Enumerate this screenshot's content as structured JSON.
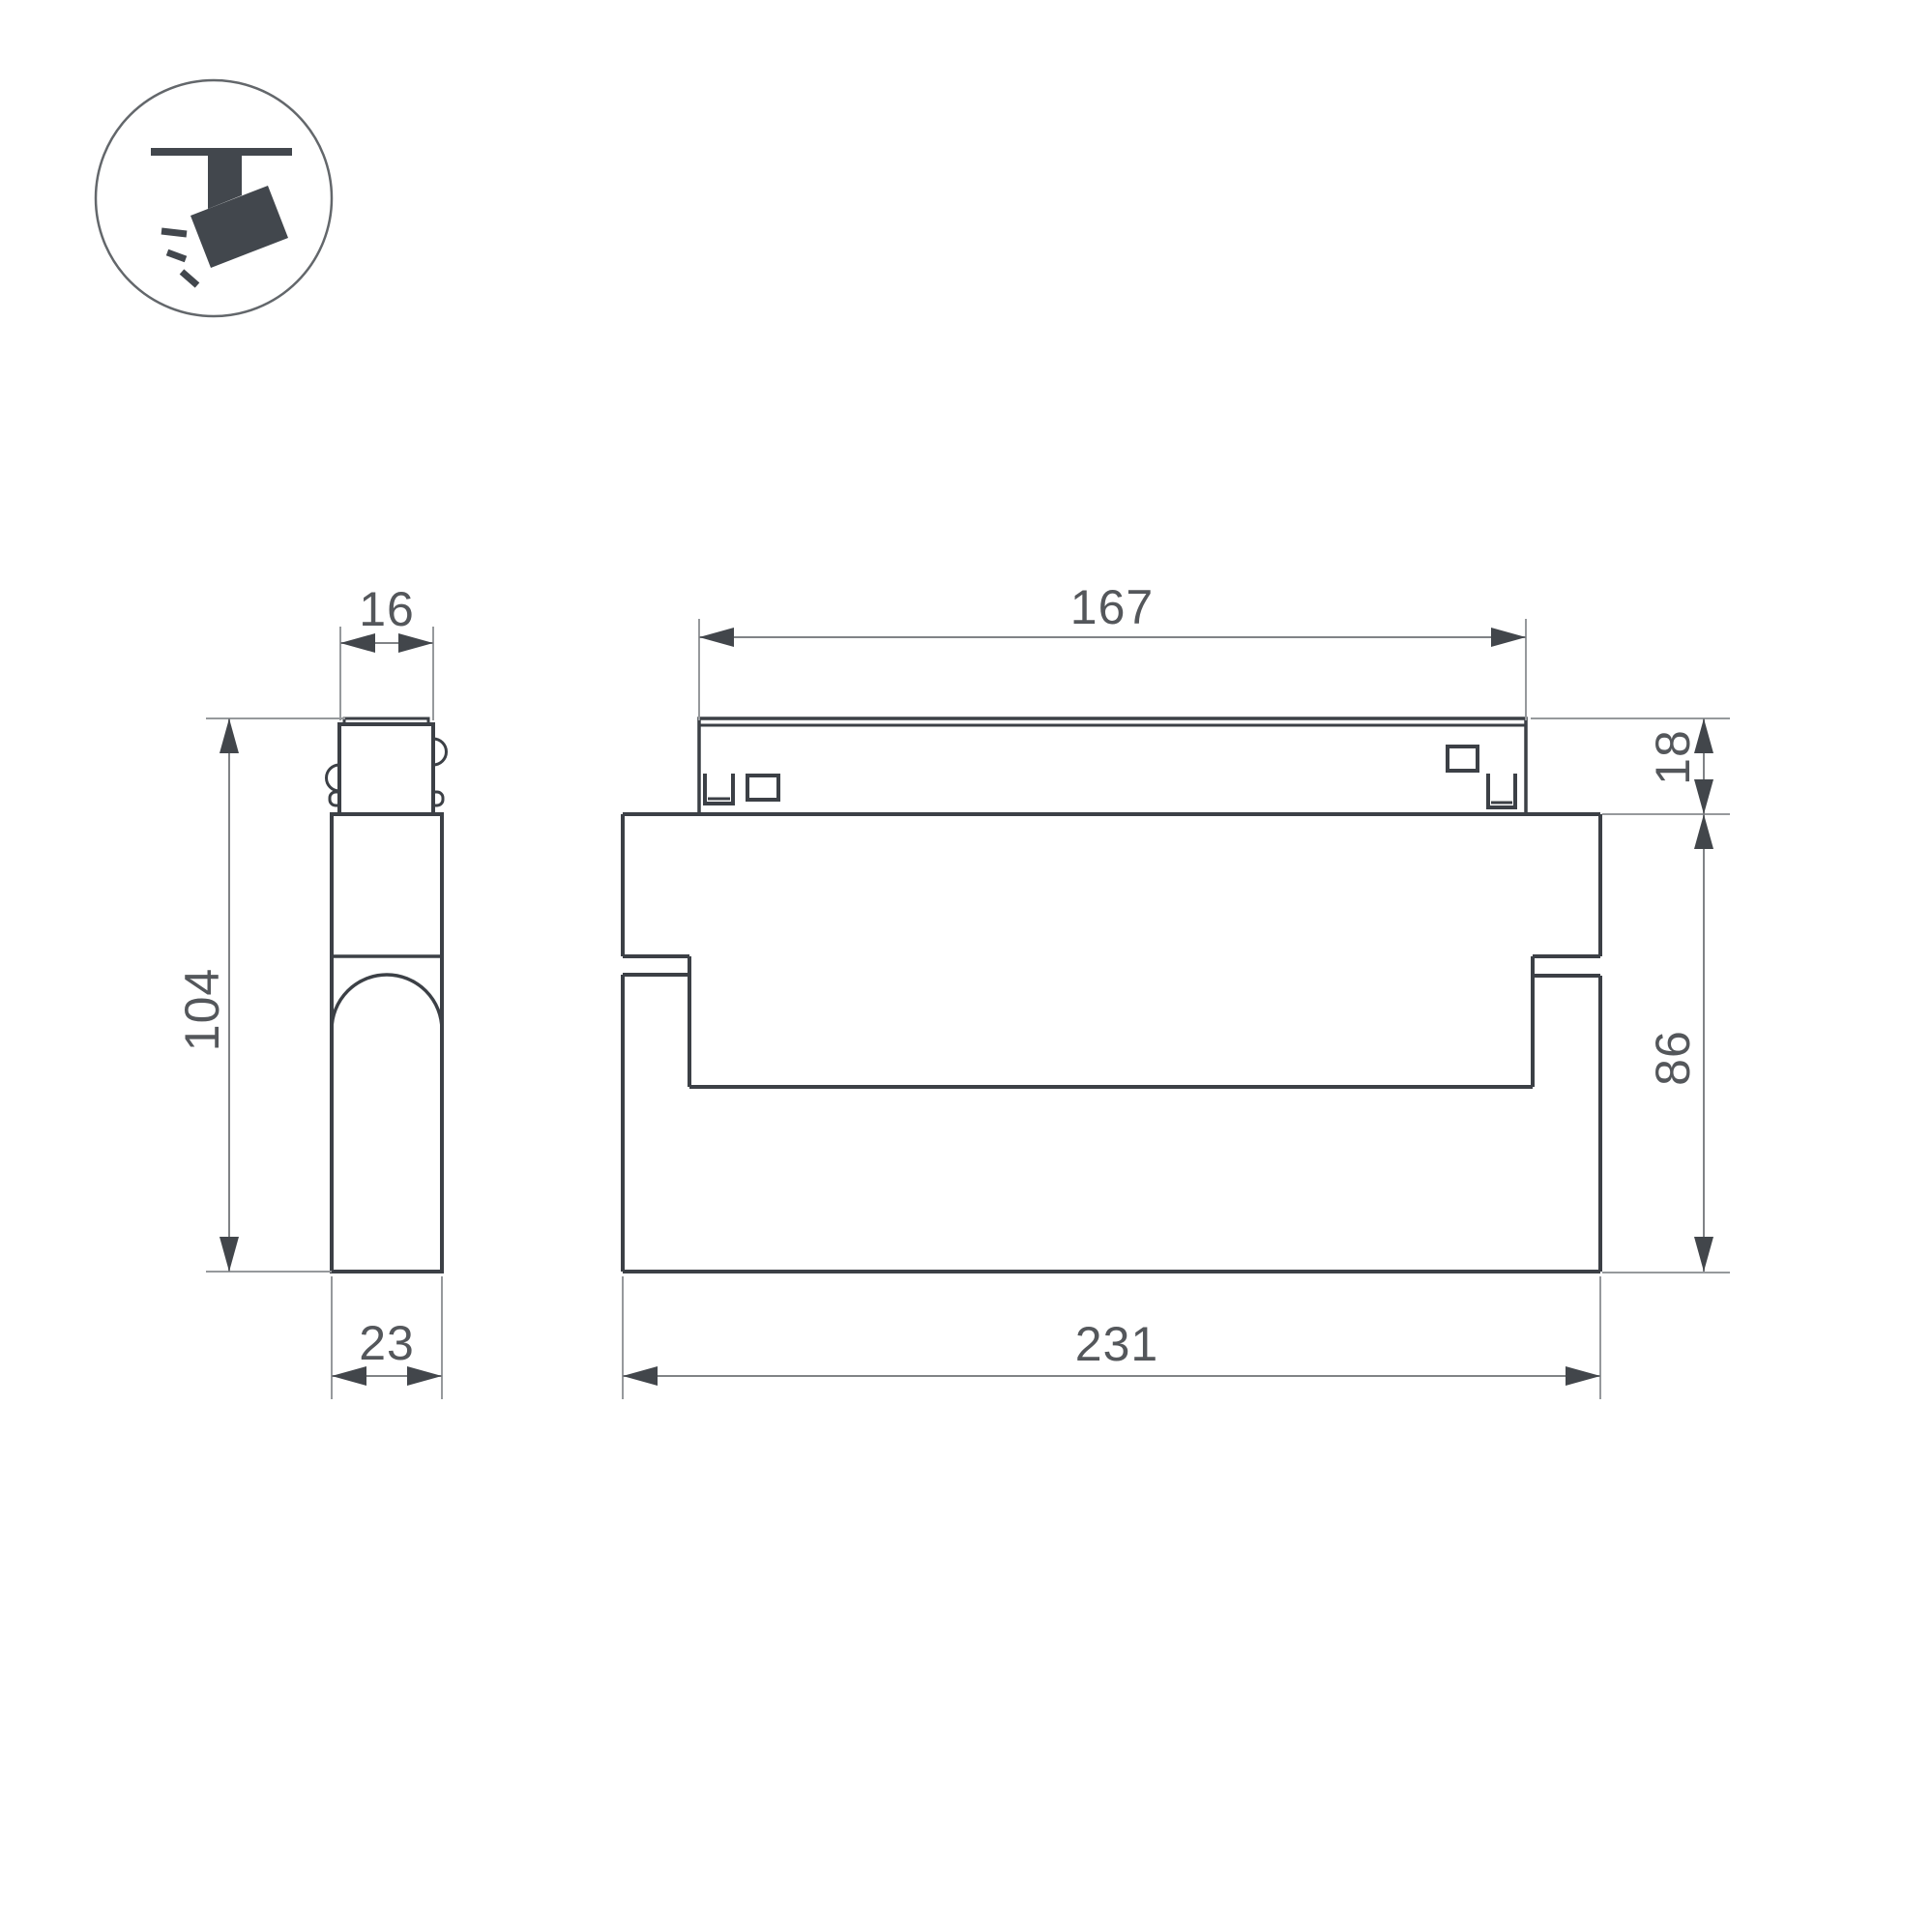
{
  "drawing": {
    "type": "technical-dimension-drawing",
    "subject": "magnetic-track-spotlight",
    "icon": {
      "name": "ceiling-track-spotlight",
      "color": "#42474d",
      "circle_stroke": "#63676b"
    },
    "style": {
      "outline_color": "#3c4046",
      "dim_line_color": "#808386",
      "ext_line_color": "#96999c",
      "arrow_color": "#42464b",
      "text_color": "#54575b",
      "background": "#ffffff"
    },
    "views": {
      "side": {
        "label": "side-view",
        "dims": {
          "top_width": "16",
          "height": "104",
          "depth": "23"
        }
      },
      "front": {
        "label": "front-view",
        "dims": {
          "adapter_length": "167",
          "adapter_height": "18",
          "body_height": "86",
          "body_length": "231"
        }
      }
    }
  }
}
